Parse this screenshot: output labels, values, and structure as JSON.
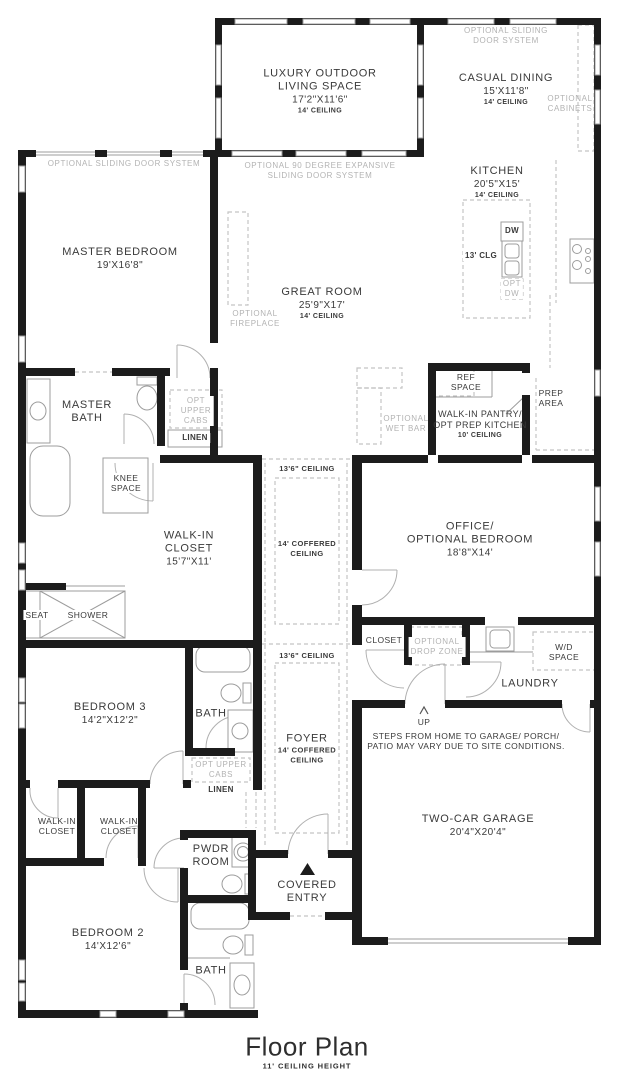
{
  "colors": {
    "wall": "#1c1c1c",
    "optional_gray": "#b3b3b3",
    "text": "#3a3a3a",
    "fixture_line": "#9c9c9c",
    "dashed_line": "#c4c4c4",
    "door_line": "#b0b0b0"
  },
  "icons": {
    "up_arrow": "chevron-up-icon",
    "entry_marker": "triangle-up-icon"
  },
  "title": {
    "main": "Floor Plan",
    "sub": "11' CEILING HEIGHT"
  },
  "rooms": {
    "outdoor_living": {
      "n1": "LUXURY OUTDOOR",
      "n2": "LIVING SPACE",
      "dim": "17'2\"X11'6\"",
      "ceiling": "14' CEILING"
    },
    "casual_dining": {
      "n1": "CASUAL DINING",
      "dim": "15'X11'8\"",
      "ceiling": "14' CEILING"
    },
    "kitchen": {
      "n1": "KITCHEN",
      "dim": "20'5\"X15'",
      "ceiling": "14' CEILING"
    },
    "great_room": {
      "n1": "GREAT ROOM",
      "dim": "25'9\"X17'",
      "ceiling": "14' CEILING"
    },
    "master_bedroom": {
      "n1": "MASTER BEDROOM",
      "dim": "19'X16'8\""
    },
    "master_bath": {
      "n1": "MASTER",
      "n2": "BATH"
    },
    "walk_in_closet": {
      "n1": "WALK-IN",
      "n2": "CLOSET",
      "dim": "15'7\"X11'"
    },
    "office": {
      "n1": "OFFICE/",
      "n2": "OPTIONAL BEDROOM",
      "dim": "18'8\"X14'"
    },
    "pantry": {
      "n1": "WALK-IN PANTRY/",
      "n2": "OPT PREP KITCHEN",
      "ceiling": "10' CEILING"
    },
    "bedroom3": {
      "n1": "BEDROOM 3",
      "dim": "14'2\"X12'2\""
    },
    "bath3": {
      "n1": "BATH"
    },
    "bedroom2": {
      "n1": "BEDROOM 2",
      "dim": "14'X12'6\""
    },
    "bath2": {
      "n1": "BATH"
    },
    "pwdr": {
      "n1": "PWDR",
      "n2": "ROOM"
    },
    "laundry": {
      "n1": "LAUNDRY"
    },
    "foyer": {
      "n1": "FOYER",
      "c1": "14' COFFERED",
      "c2": "CEILING"
    },
    "garage": {
      "n1": "TWO-CAR GARAGE",
      "dim": "20'4\"X20'4\""
    },
    "covered_entry": {
      "n1": "COVERED",
      "n2": "ENTRY"
    },
    "wic_a": {
      "n1": "WALK-IN",
      "n2": "CLOSET"
    },
    "wic_b": {
      "n1": "WALK-IN",
      "n2": "CLOSET"
    }
  },
  "annotations": {
    "opt_sliding_top": {
      "l1": "OPTIONAL SLIDING",
      "l2": "DOOR SYSTEM"
    },
    "opt_cabinets": {
      "l1": "OPTIONAL",
      "l2": "CABINETS"
    },
    "opt_sliding_master": {
      "l1": "OPTIONAL SLIDING DOOR SYSTEM"
    },
    "opt_90": {
      "l1": "OPTIONAL 90 DEGREE EXPANSIVE",
      "l2": "SLIDING DOOR SYSTEM"
    },
    "opt_fireplace": {
      "l1": "OPTIONAL",
      "l2": "FIREPLACE"
    },
    "opt_wet_bar": {
      "l1": "OPTIONAL",
      "l2": "WET BAR"
    },
    "opt_upper_cabs_1": {
      "l1": "OPT",
      "l2": "UPPER",
      "l3": "CABS"
    },
    "linen_1": "LINEN",
    "knee_space": {
      "l1": "KNEE",
      "l2": "SPACE"
    },
    "seat": "SEAT",
    "shower": "SHOWER",
    "ref_space": {
      "l1": "REF",
      "l2": "SPACE"
    },
    "prep_area": {
      "l1": "PREP",
      "l2": "AREA"
    },
    "dw": "DW",
    "clg13": "13' CLG",
    "opt_dw": {
      "l1": "OPT",
      "l2": "DW"
    },
    "hall_ceiling": "13'6\" CEILING",
    "hall_coffered": {
      "l1": "14' COFFERED",
      "l2": "CEILING"
    },
    "foyer_ceiling": "13'6\" CEILING",
    "closet": "CLOSET",
    "opt_drop_zone": {
      "l1": "OPTIONAL",
      "l2": "DROP ZONE"
    },
    "wd_space": {
      "l1": "W/D",
      "l2": "SPACE"
    },
    "up": "UP",
    "steps": {
      "l1": "STEPS FROM HOME TO GARAGE/ PORCH/",
      "l2": "PATIO MAY VARY DUE TO SITE CONDITIONS."
    },
    "opt_upper_cabs_2": {
      "l1": "OPT UPPER",
      "l2": "CABS"
    },
    "linen_2": "LINEN"
  }
}
